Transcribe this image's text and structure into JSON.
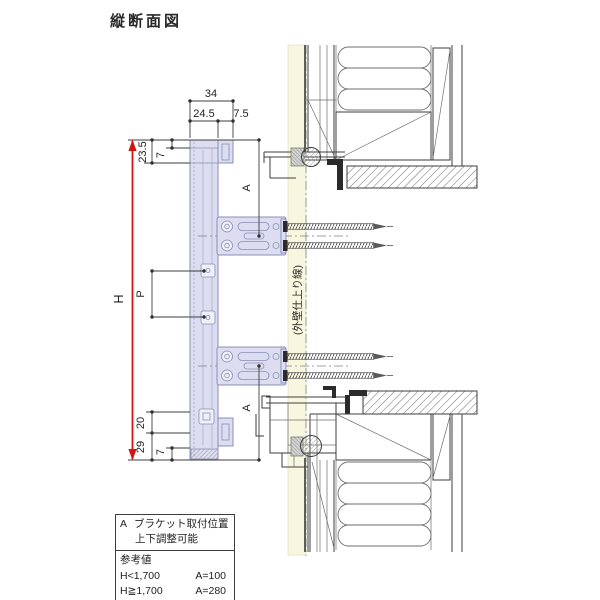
{
  "title": "縦断面図",
  "dims": {
    "total_width": "34",
    "body_width": "24.5",
    "hook_width": "7.5",
    "head_offset": "23.5",
    "head_hook": "7",
    "height": "H",
    "pitch": "P",
    "bracket_top": "A",
    "bracket_bottom": "A",
    "bottom_offset": "20",
    "bottom_height": "29",
    "bottom_hook": "7"
  },
  "labels": {
    "wall_finish_line": "(外壁仕上り線)"
  },
  "colors": {
    "dim_red": "#cf1414",
    "unit_fill": "#dcddf0",
    "unit_stroke": "#8a90b4",
    "finish_band": "#f7f6de"
  },
  "note_table": {
    "symbol": "A",
    "header_line1": "ブラケット取付位置",
    "header_line2": "上下調整可能",
    "ref_title": "参考値",
    "rows": [
      {
        "cond": "H<1,700",
        "val": "A=100"
      },
      {
        "cond": "H≧1,700",
        "val": "A=280"
      }
    ]
  }
}
